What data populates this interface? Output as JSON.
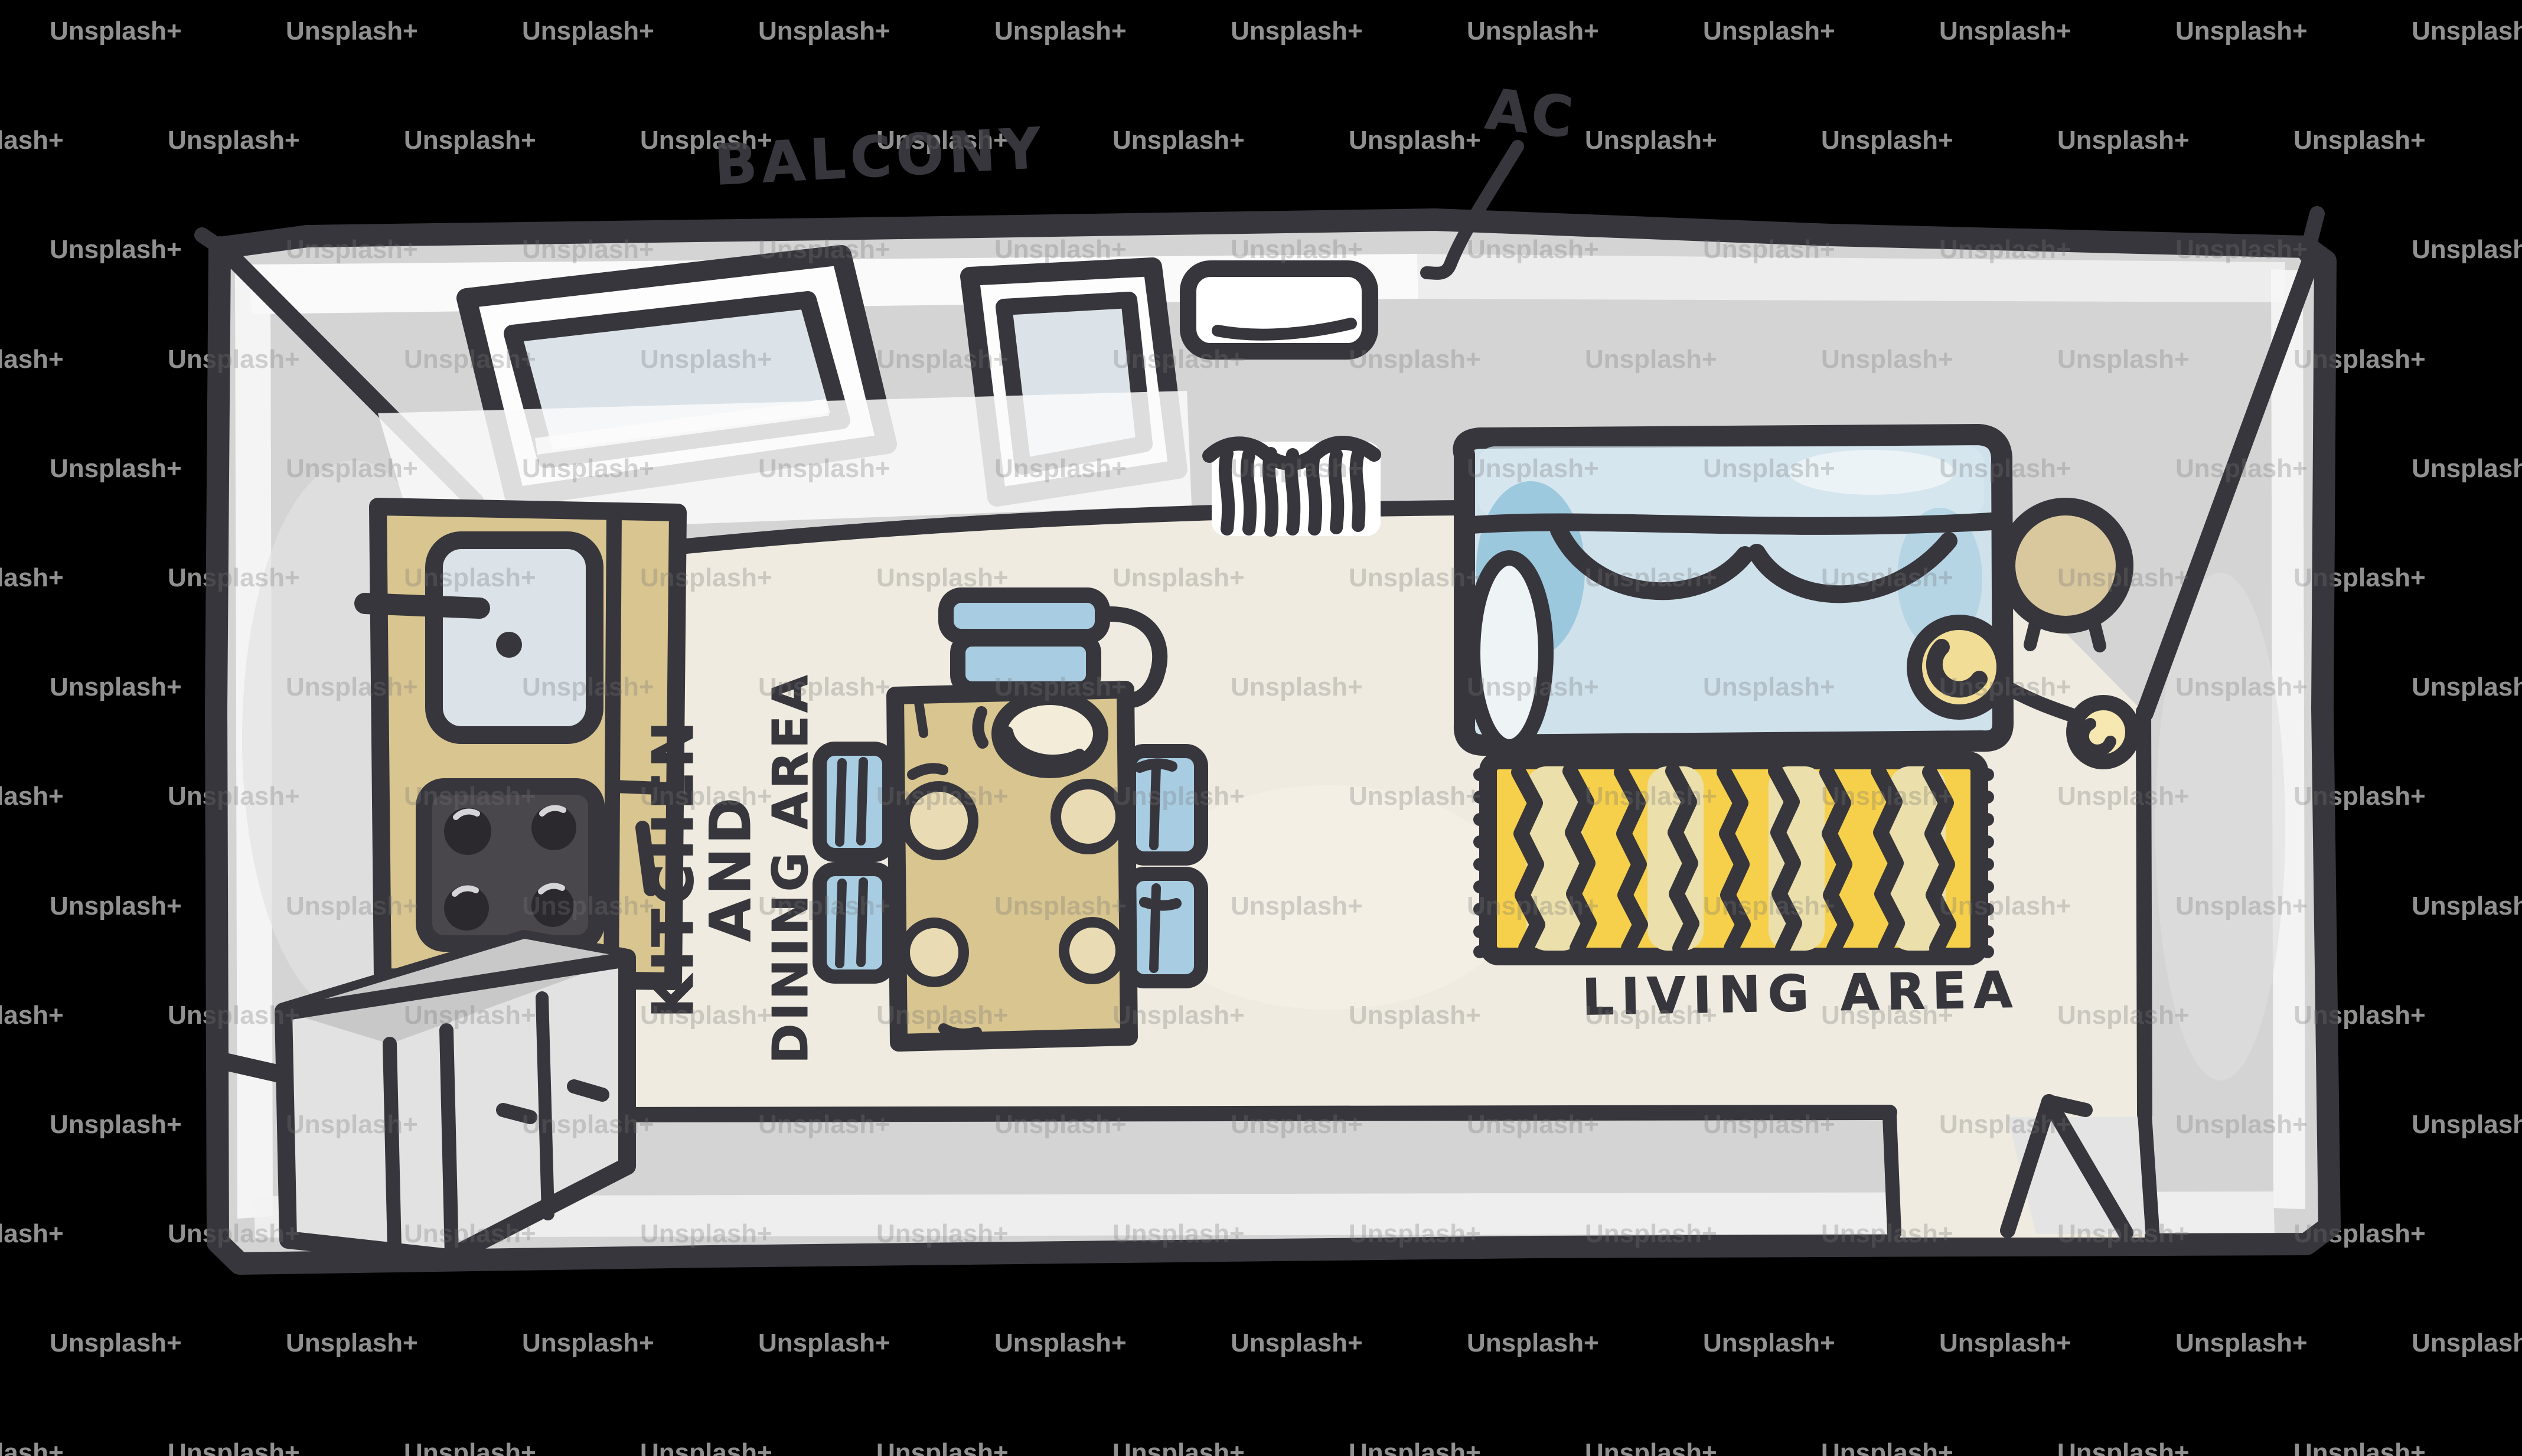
{
  "watermark": {
    "label": "Unsplash+"
  },
  "labels": {
    "balcony": "BALCONY",
    "ac": "AC",
    "kitchen_line1": "KITCHEN",
    "kitchen_line2": "AND",
    "kitchen_line3": "DINING AREA",
    "living": "LIVING AREA"
  },
  "colors": {
    "background": "#000000",
    "ink": "#37363c",
    "wall-gray": "#d4d4d4",
    "floor-cream": "#efebe0",
    "cabinet-tan": "#d8c590",
    "plate-tan": "#e9dcb4",
    "sofa-blue": "#cfe1eb",
    "chair-blue": "#a8cde2",
    "glass-blue": "#dbe3e9",
    "rug-yellow": "#f7d04b",
    "rug-pale": "#ebdfab",
    "lamp-yellow": "#f2dd96",
    "stove-dark": "#49464c",
    "watermark-gray": "#9b9b9b"
  }
}
